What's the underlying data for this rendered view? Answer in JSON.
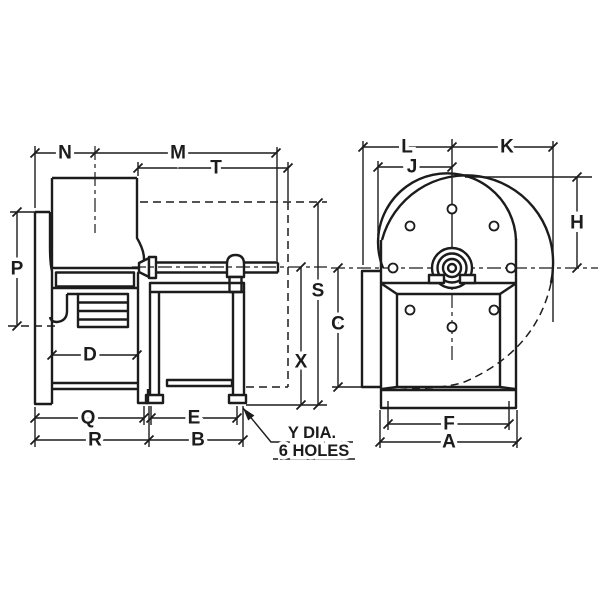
{
  "diagram": {
    "background_color": "#ffffff",
    "line_color": "#1c1c1c",
    "side_view": {
      "labels": {
        "n": "N",
        "m": "M",
        "t": "T",
        "p": "P",
        "d": "D",
        "s": "S",
        "x": "X",
        "q": "Q",
        "e": "E",
        "r": "R",
        "b": "B"
      }
    },
    "front_view": {
      "labels": {
        "l": "L",
        "k": "K",
        "j": "J",
        "h": "H",
        "c": "C",
        "f": "F",
        "a": "A"
      }
    },
    "note": {
      "line1": "Y DIA.",
      "line2": "6 HOLES"
    }
  }
}
